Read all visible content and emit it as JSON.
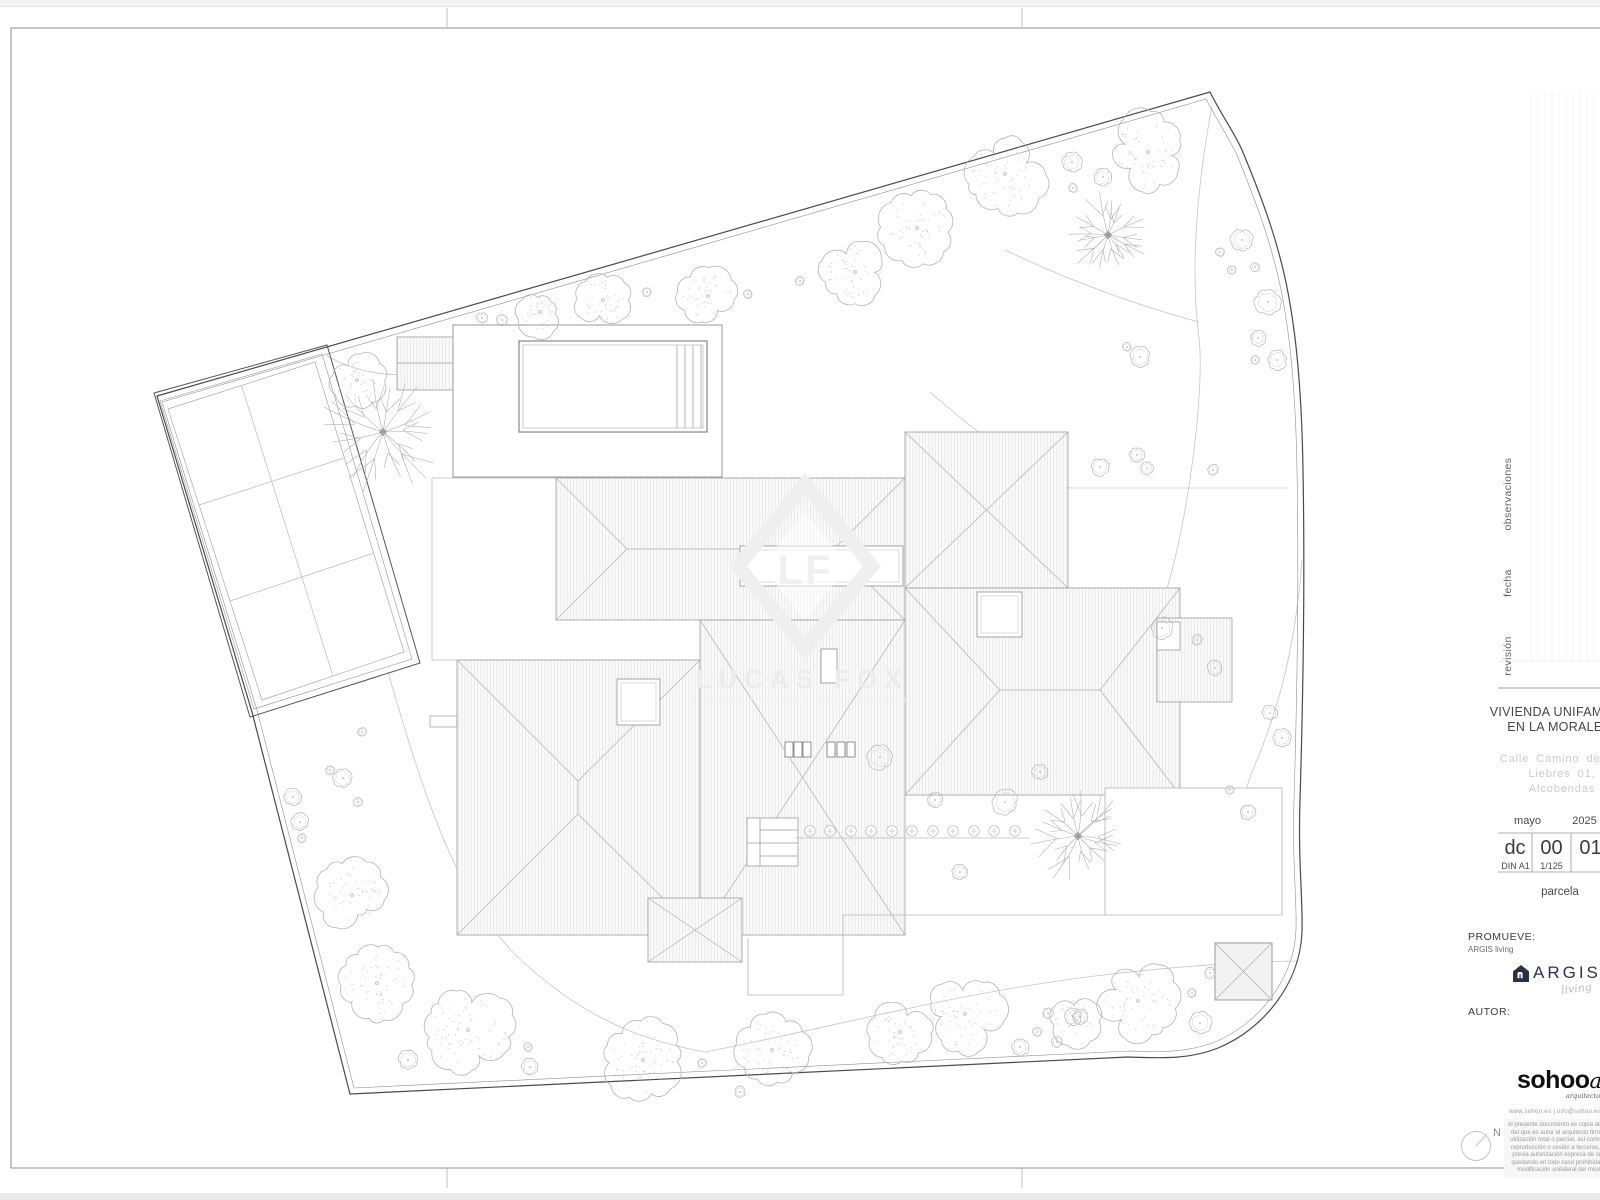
{
  "title_block": {
    "revision_labels": [
      "observaciones",
      "fecha",
      "revisión"
    ],
    "project_title": [
      "VIVIENDA UNIFAMILIAR",
      "EN LA MORALEJA"
    ],
    "address": [
      "Calle Camino de las",
      "Liebres 01,",
      "Alcobendas"
    ],
    "date": {
      "month": "mayo",
      "year": "2025"
    },
    "code": {
      "type": "dc",
      "num": "00",
      "sheet": "01"
    },
    "format": {
      "paper": "DIN A1",
      "scale": "1/125"
    },
    "sheet_name": "parcela",
    "promote": {
      "label": "PROMUEVE:",
      "name": "ARGIS living"
    },
    "argis": {
      "wordmark": "ARGIS",
      "script": "living"
    },
    "author_label": "AUTOR:",
    "sohoo": {
      "wordmark": "sohoo",
      "script": "a",
      "tagline": "arquitectos",
      "contact": "www.sohoo.es | info@sohoo.es"
    },
    "disclaimer": [
      "el presente documento es copia de su or",
      "del que es autor el arquitecto firmante,",
      "utilización total o parcial, así como cual",
      "reproducción o cesión a terceros, requ",
      "previa autorización expresa de su aut",
      "quedando en todo caso prohibida cual",
      "modificación unilateral del mismo."
    ],
    "north_label": "N"
  },
  "watermark": {
    "monogram": "LF",
    "name": "LUCAS FOX",
    "tagline": "INTERNATIONAL PROPERTIES"
  },
  "colors": {
    "paper": "#ffffff",
    "border": "#8c8c8c",
    "boundary": "#4a4a4a",
    "boundary_inner": "#909090",
    "roof_line": "#9b9b9b",
    "hatch": "#dedede",
    "ridge": "#b0b0b0",
    "garden_line": "#c6c6c6",
    "veg": "#b5b5b5",
    "veg_stipple": "#cccccc",
    "bare": "#ababab",
    "navy": "#27304d",
    "text_dark": "#3f3f3f",
    "text_gray": "#c9c9c9",
    "watermark": "#ededed"
  },
  "site": {
    "trees": [
      [
        540,
        312,
        24
      ],
      [
        603,
        300,
        26
      ],
      [
        708,
        296,
        28
      ],
      [
        855,
        272,
        32
      ],
      [
        917,
        228,
        35
      ],
      [
        1005,
        174,
        38
      ],
      [
        1148,
        152,
        38
      ],
      [
        357,
        380,
        27
      ],
      [
        352,
        895,
        33
      ],
      [
        377,
        983,
        36
      ],
      [
        468,
        1030,
        44
      ],
      [
        643,
        1060,
        38
      ],
      [
        772,
        1050,
        34
      ],
      [
        900,
        1032,
        29
      ],
      [
        965,
        1014,
        38
      ],
      [
        1075,
        1020,
        24
      ],
      [
        1138,
        1001,
        39
      ]
    ],
    "shrubs": [
      [
        482,
        318,
        5
      ],
      [
        502,
        320,
        5
      ],
      [
        647,
        292,
        4
      ],
      [
        748,
        294,
        4
      ],
      [
        800,
        281,
        4
      ],
      [
        1072,
        162,
        9
      ],
      [
        1103,
        177,
        8
      ],
      [
        1073,
        188,
        4
      ],
      [
        1242,
        240,
        10
      ],
      [
        1220,
        252,
        4
      ],
      [
        1232,
        270,
        4
      ],
      [
        1255,
        267,
        4
      ],
      [
        1268,
        302,
        12
      ],
      [
        1258,
        338,
        7
      ],
      [
        1255,
        360,
        4
      ],
      [
        1277,
        360,
        9
      ],
      [
        1127,
        347,
        4
      ],
      [
        1140,
        357,
        9
      ],
      [
        1100,
        467,
        8
      ],
      [
        1137,
        455,
        7
      ],
      [
        1147,
        468,
        6
      ],
      [
        1213,
        470,
        5
      ],
      [
        1162,
        628,
        10
      ],
      [
        1197,
        640,
        5
      ],
      [
        1215,
        668,
        7
      ],
      [
        1270,
        713,
        7
      ],
      [
        1282,
        738,
        8
      ],
      [
        1248,
        812,
        7
      ],
      [
        1230,
        790,
        4
      ],
      [
        880,
        757,
        12
      ],
      [
        935,
        800,
        7
      ],
      [
        1005,
        802,
        12
      ],
      [
        1040,
        772,
        7
      ],
      [
        960,
        872,
        7
      ],
      [
        293,
        797,
        8
      ],
      [
        300,
        822,
        8
      ],
      [
        302,
        838,
        4
      ],
      [
        343,
        778,
        9
      ],
      [
        330,
        770,
        4
      ],
      [
        362,
        732,
        4
      ],
      [
        358,
        802,
        4
      ],
      [
        408,
        1060,
        9
      ],
      [
        528,
        1047,
        4
      ],
      [
        530,
        1067,
        8
      ],
      [
        740,
        1092,
        5
      ],
      [
        702,
        1063,
        4
      ],
      [
        1020,
        1047,
        8
      ],
      [
        1048,
        1013,
        5
      ],
      [
        1037,
        1032,
        4
      ],
      [
        1057,
        1042,
        5
      ],
      [
        1073,
        1017,
        8
      ],
      [
        1192,
        993,
        4
      ],
      [
        1200,
        1023,
        10
      ],
      [
        1080,
        1017,
        7
      ],
      [
        1210,
        973,
        5
      ]
    ],
    "flowers_y": 831,
    "flowers_x": [
      810,
      830,
      851,
      871,
      892,
      912,
      933,
      953,
      974,
      994,
      1015
    ],
    "bare_trees": [
      [
        383,
        432,
        58
      ],
      [
        1108,
        235,
        40
      ],
      [
        1078,
        836,
        46
      ]
    ]
  }
}
